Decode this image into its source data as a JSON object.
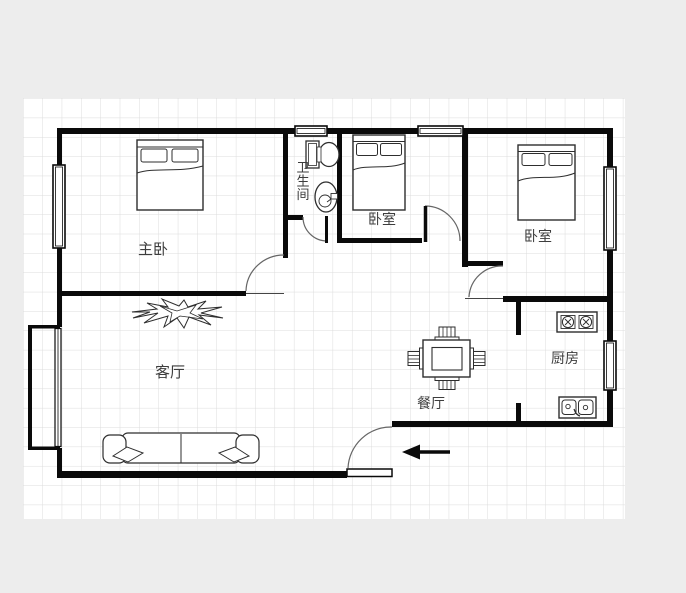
{
  "canvas": {
    "background_color": "#ededed",
    "paper_color": "#ffffff",
    "grid_color": "#dcdcdc"
  },
  "colors": {
    "wall": "#0a0a0a",
    "furniture_line": "#2e2e2e",
    "door_arc": "#666666",
    "label_text": "#3d3d3d"
  },
  "rooms": {
    "master_bedroom": {
      "label": "主卧"
    },
    "bathroom": {
      "label": "卫生间",
      "text_orientation": "vertical"
    },
    "bedroom_2": {
      "label": "卧室"
    },
    "bedroom_3": {
      "label": "卧室"
    },
    "living_room": {
      "label": "客厅"
    },
    "dining_room": {
      "label": "餐厅"
    },
    "kitchen": {
      "label": "厨房"
    }
  },
  "fixtures": [
    "double-bed-master",
    "double-bed-2",
    "double-bed-3",
    "sofa",
    "plant-decor",
    "dining-table-with-4-chairs",
    "toilet",
    "wash-basin",
    "stove-2-burners",
    "kitchen-double-sink"
  ],
  "openings": {
    "windows": [
      "top-wall-bathroom",
      "top-wall-bedroom-2",
      "left-wall-master",
      "left-bay-window-living",
      "right-wall-bedroom-3",
      "right-wall-kitchen"
    ],
    "doors": [
      "master-bedroom-door",
      "bathroom-door",
      "bedroom-2-door",
      "bedroom-3-door",
      "entrance-door"
    ]
  },
  "entrance": {
    "arrow_direction": "left"
  }
}
